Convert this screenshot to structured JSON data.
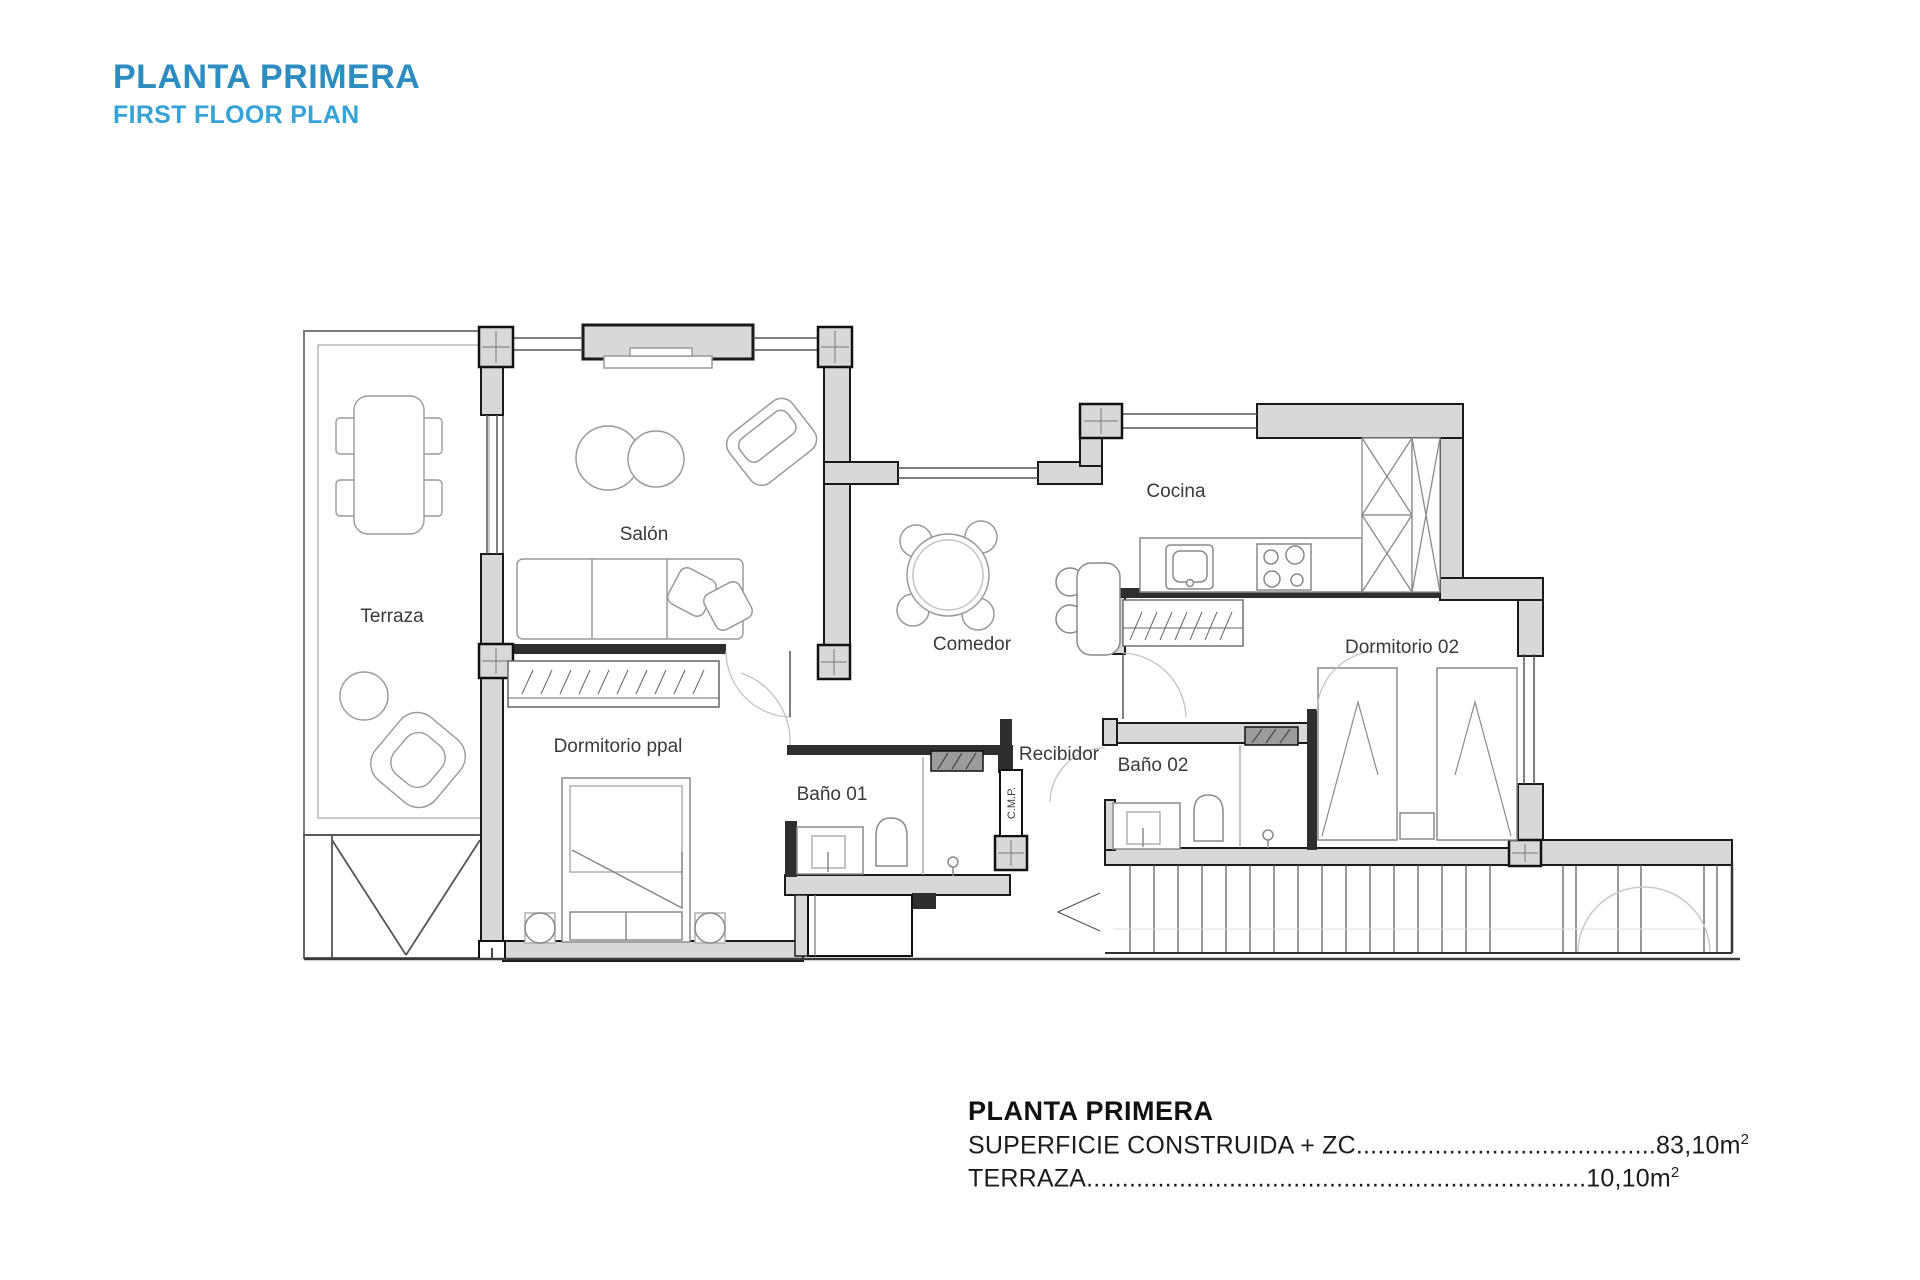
{
  "header": {
    "title": "PLANTA PRIMERA",
    "subtitle": "FIRST FLOOR PLAN"
  },
  "colors": {
    "title_blue": "#2d8cc0",
    "subtitle_blue": "#35a3d8",
    "wall_gray": "#d8d8d8",
    "wall_dark": "#2e2e2e"
  },
  "rooms": {
    "terraza": "Terraza",
    "salon": "Salón",
    "comedor": "Comedor",
    "cocina": "Cocina",
    "dormitorio_ppal": "Dormitorio ppal",
    "dormitorio_02": "Dormitorio 02",
    "bano_01": "Baño 01",
    "bano_02": "Baño 02",
    "recibidor": "Recibidor",
    "cmp": "C.M.P."
  },
  "summary": {
    "title": "PLANTA PRIMERA",
    "lines": [
      {
        "label": "SUPERFICIE CONSTRUIDA + ZC",
        "dots": "..........................................",
        "value": "83,10m",
        "sup": "2"
      },
      {
        "label": "TERRAZA",
        "dots": "......................................................................",
        "value": "10,10m",
        "sup": "2"
      }
    ]
  }
}
